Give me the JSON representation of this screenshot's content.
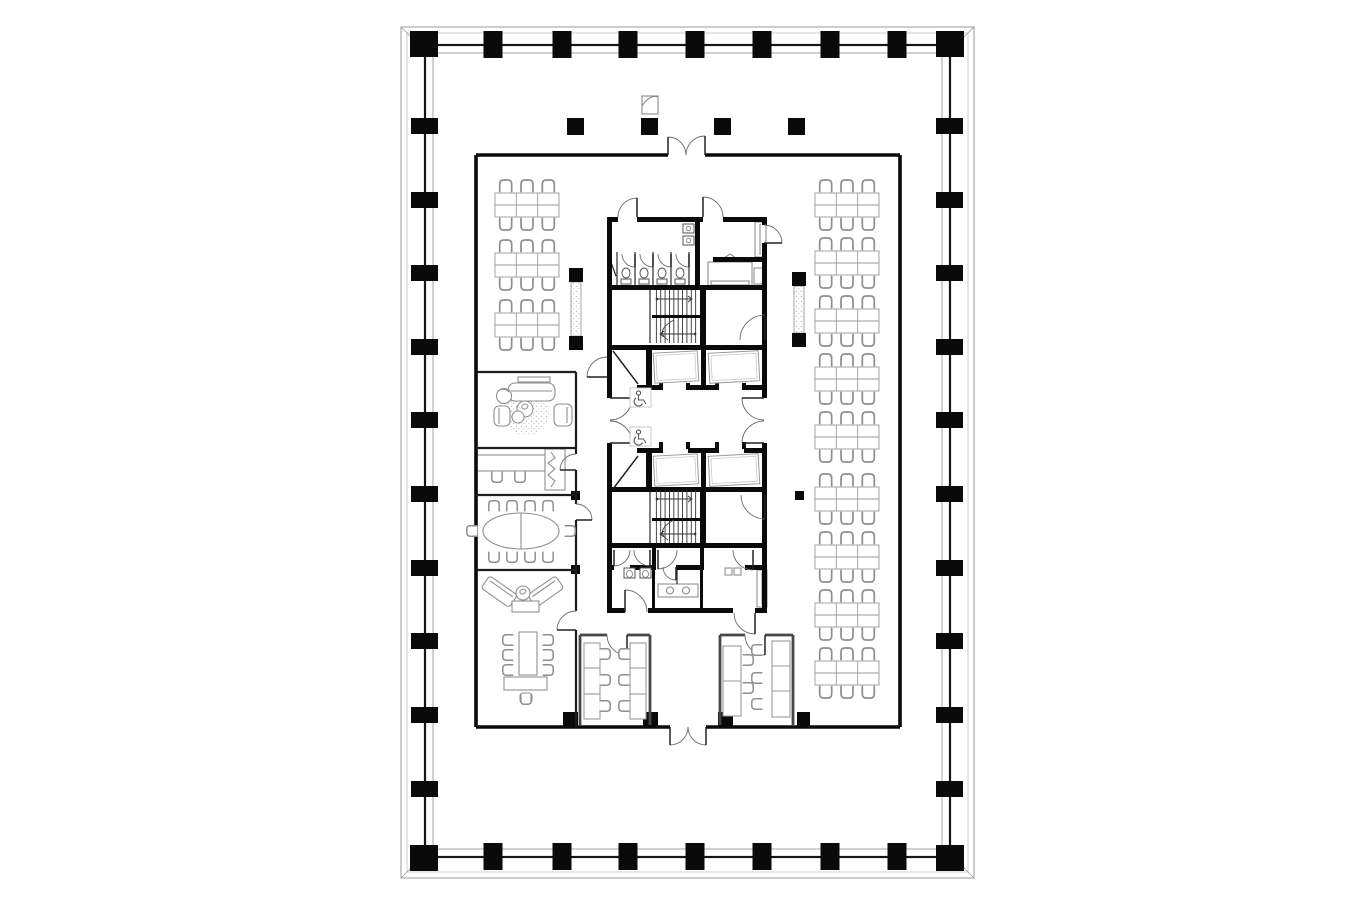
{
  "meta": {
    "document_type": "architectural-floor-plan",
    "view": "typical office tower floor plan, top view",
    "visible_text": ""
  },
  "palette": {
    "background": "#ffffff",
    "wall_black": "#0a0a0a",
    "wall_medium": "#3a3a3a",
    "shell_line": "#9a9a9a",
    "furniture": "#8f8f8f",
    "furniture_light": "#b5b5b5",
    "stipple": "#b9b9b9",
    "icon": "#5a5a5a"
  },
  "rooms": [
    {
      "name": "open-office-north",
      "desks": 0
    },
    {
      "name": "open-office-left",
      "desks": 18
    },
    {
      "name": "open-office-right",
      "desks": 54
    },
    {
      "name": "lounge",
      "seats": 4
    },
    {
      "name": "small-office",
      "seats": 2
    },
    {
      "name": "conference-room",
      "seats": 10
    },
    {
      "name": "meeting-lounge",
      "seats": 9
    },
    {
      "name": "office-cell-left",
      "workstations": 6
    },
    {
      "name": "office-cell-right",
      "workstations": 5
    },
    {
      "name": "womens-wc",
      "stalls": 4
    },
    {
      "name": "mens-wc",
      "urinals": 2
    },
    {
      "name": "pantry",
      "fixtures": 2
    },
    {
      "name": "elevator-lobby",
      "accessible_markers": 2
    },
    {
      "name": "stair-north",
      "flights": 2
    },
    {
      "name": "stair-south",
      "flights": 2
    }
  ],
  "plan": {
    "perimeter": {
      "outer": [
        401,
        27,
        974,
        878
      ],
      "outer2": [
        407,
        33,
        968,
        872
      ],
      "wall": [
        425,
        45,
        950,
        857
      ],
      "inner": [
        433,
        53,
        942,
        849
      ],
      "top_xs": [
        493,
        562,
        628,
        695,
        762,
        830,
        897
      ],
      "side_ys": [
        126,
        200,
        273,
        347,
        420,
        494,
        568,
        641,
        715,
        789
      ],
      "corners": [
        [
          410,
          31
        ],
        [
          936,
          31
        ],
        [
          410,
          845
        ],
        [
          936,
          845
        ]
      ]
    },
    "band_columns": [
      [
        567,
        118
      ],
      [
        641,
        118
      ],
      [
        714,
        118
      ],
      [
        788,
        118
      ]
    ],
    "fire_cabinet": [
      642,
      96,
      16,
      18
    ],
    "small_columns": [
      [
        571,
        491,
        9,
        9
      ],
      [
        571,
        565,
        9,
        9
      ],
      [
        795,
        491,
        9,
        9
      ]
    ],
    "wall_columns": [
      [
        563,
        712,
        15,
        14
      ],
      [
        643,
        712,
        15,
        14
      ],
      [
        718,
        712,
        15,
        14
      ],
      [
        797,
        712,
        13,
        14
      ]
    ],
    "screens": [
      {
        "x": 571,
        "y": 282,
        "w": 10,
        "h": 54,
        "caps": [
          [
            569,
            268
          ],
          [
            569,
            336
          ]
        ]
      },
      {
        "x": 794,
        "y": 286,
        "w": 10,
        "h": 47,
        "caps": [
          [
            792,
            272
          ],
          [
            792,
            333
          ]
        ]
      }
    ],
    "clusters": {
      "w": 64,
      "h": 24,
      "cols": 3,
      "left": {
        "x": 495,
        "ys": [
          193,
          253,
          313
        ]
      },
      "right": {
        "x": 815,
        "ys": [
          193,
          251,
          309,
          367,
          425,
          487,
          545,
          603,
          661
        ]
      }
    },
    "walls": {
      "inner_box": [
        [
          476,
          155,
          668,
          155
        ],
        [
          705,
          155,
          900,
          155
        ],
        [
          900,
          155,
          900,
          727
        ],
        [
          706,
          727,
          900,
          727
        ],
        [
          476,
          727,
          670,
          727
        ],
        [
          476,
          155,
          476,
          727
        ]
      ],
      "left_rooms": [
        [
          476,
          372,
          576,
          372
        ],
        [
          476,
          448,
          576,
          448
        ],
        [
          476,
          495,
          576,
          495
        ],
        [
          476,
          570,
          576,
          570
        ],
        [
          576,
          372,
          576,
          454
        ],
        [
          576,
          470,
          576,
          504
        ],
        [
          576,
          520,
          576,
          611
        ],
        [
          576,
          630,
          576,
          727
        ]
      ],
      "offices": [
        [
          580,
          635,
          607,
          635
        ],
        [
          627,
          635,
          650,
          635
        ],
        [
          580,
          635,
          580,
          725
        ],
        [
          650,
          635,
          650,
          725
        ],
        [
          720,
          635,
          745,
          635
        ],
        [
          765,
          635,
          793,
          635
        ],
        [
          720,
          635,
          720,
          725
        ],
        [
          793,
          635,
          793,
          725
        ]
      ],
      "thin": [
        [
          617,
          252,
          617,
          285
        ],
        [
          635,
          252,
          635,
          285
        ],
        [
          653,
          252,
          653,
          285
        ],
        [
          671,
          252,
          671,
          285
        ],
        [
          689,
          252,
          689,
          285
        ],
        [
          608,
          254,
          616,
          276
        ],
        [
          650,
          290,
          650,
          343
        ],
        [
          650,
          490,
          650,
          543
        ],
        [
          677,
          567,
          677,
          584
        ]
      ]
    },
    "core_wall_rects": [
      [
        607,
        217,
        11,
        5
      ],
      [
        637,
        217,
        66,
        5
      ],
      [
        723,
        217,
        44,
        5
      ],
      [
        607,
        217,
        5,
        181
      ],
      [
        607,
        443,
        5,
        170
      ],
      [
        762,
        217,
        5,
        8
      ],
      [
        762,
        243,
        5,
        155
      ],
      [
        762,
        443,
        5,
        170
      ],
      [
        607,
        608,
        18,
        5
      ],
      [
        648,
        608,
        85,
        5
      ],
      [
        755,
        608,
        12,
        5
      ],
      [
        695,
        217,
        5,
        73
      ],
      [
        607,
        285,
        160,
        5
      ],
      [
        700,
        285,
        6,
        65
      ],
      [
        607,
        345,
        160,
        5
      ],
      [
        637,
        385,
        26,
        5
      ],
      [
        688,
        385,
        31,
        5
      ],
      [
        744,
        385,
        18,
        5
      ],
      [
        646,
        345,
        6,
        45
      ],
      [
        701,
        345,
        5,
        45
      ],
      [
        637,
        448,
        26,
        5
      ],
      [
        688,
        448,
        31,
        5
      ],
      [
        744,
        448,
        18,
        5
      ],
      [
        646,
        448,
        6,
        44
      ],
      [
        701,
        448,
        5,
        44
      ],
      [
        607,
        487,
        160,
        5
      ],
      [
        700,
        487,
        6,
        61
      ],
      [
        607,
        543,
        160,
        5
      ],
      [
        652,
        548,
        4,
        22
      ],
      [
        700,
        548,
        4,
        22
      ],
      [
        607,
        565,
        7,
        5
      ],
      [
        630,
        565,
        25,
        5
      ],
      [
        676,
        565,
        27,
        5
      ],
      [
        745,
        565,
        17,
        5
      ],
      [
        652,
        565,
        3,
        43
      ],
      [
        700,
        565,
        3,
        43
      ],
      [
        713,
        257,
        49,
        5
      ]
    ],
    "jambs": [
      [
        659,
        383,
        4,
        7
      ],
      [
        686,
        383,
        4,
        7
      ],
      [
        715,
        383,
        4,
        7
      ],
      [
        742,
        383,
        4,
        7
      ],
      [
        659,
        442,
        4,
        7
      ],
      [
        686,
        442,
        4,
        7
      ],
      [
        715,
        442,
        4,
        7
      ],
      [
        742,
        442,
        4,
        7
      ]
    ],
    "stairs": [
      {
        "x": 652,
        "y": 290,
        "w": 48,
        "h": 53,
        "land": 315
      },
      {
        "x": 652,
        "y": 490,
        "w": 48,
        "h": 53,
        "land": 518
      }
    ],
    "elevator_cars": [
      [
        654,
        352,
        44,
        30
      ],
      [
        709,
        352,
        50,
        30
      ],
      [
        654,
        455,
        44,
        30
      ],
      [
        709,
        455,
        50,
        30
      ]
    ],
    "doors": [
      [
        637,
        217,
        19,
        180,
        270,
        "wc-entry"
      ],
      [
        703,
        217,
        20,
        0,
        270,
        "pantry-entry"
      ],
      [
        764,
        243,
        18,
        270,
        0,
        "pantry-east"
      ],
      [
        765,
        340,
        25,
        180,
        270,
        "stair-north-room"
      ],
      [
        610,
        398,
        22,
        90,
        0,
        "lobby-west-a"
      ],
      [
        610,
        443,
        22,
        270,
        0,
        "lobby-west-b"
      ],
      [
        764,
        398,
        22,
        90,
        180,
        "lobby-east-a"
      ],
      [
        764,
        443,
        22,
        270,
        180,
        "lobby-east-b"
      ],
      [
        765,
        495,
        24,
        180,
        90,
        "stair-south-room"
      ],
      [
        614,
        550,
        16,
        0,
        90,
        "vestibule-a1"
      ],
      [
        650,
        550,
        16,
        180,
        90,
        "vestibule-a2"
      ],
      [
        658,
        550,
        19,
        0,
        90,
        "vestibule-b"
      ],
      [
        753,
        550,
        20,
        180,
        90,
        "vestibule-c"
      ],
      [
        625,
        612,
        22,
        0,
        270,
        "wc-south-exit"
      ],
      [
        676,
        567,
        13,
        180,
        90,
        "wc-stall-mid"
      ],
      [
        755,
        613,
        21,
        180,
        90,
        "service-exit"
      ],
      [
        607,
        377,
        20,
        270,
        180,
        "corridor-north"
      ],
      [
        576,
        470,
        16,
        270,
        180,
        "small-office-door"
      ],
      [
        576,
        520,
        16,
        270,
        0,
        "conference-door"
      ],
      [
        576,
        630,
        19,
        270,
        180,
        "meeting-lounge-door"
      ],
      [
        627,
        635,
        20,
        180,
        90,
        "office-cell-left-door"
      ],
      [
        765,
        635,
        20,
        180,
        90,
        "office-cell-right-door"
      ],
      [
        668,
        155,
        18,
        0,
        270,
        "entry-north-left"
      ],
      [
        705,
        155,
        19,
        180,
        270,
        "entry-north-right"
      ],
      [
        670,
        727,
        18,
        0,
        90,
        "entry-south-left"
      ],
      [
        706,
        727,
        18,
        180,
        90,
        "entry-south-right"
      ],
      [
        635,
        254,
        13,
        180,
        90,
        "stall-1"
      ],
      [
        653,
        254,
        13,
        180,
        90,
        "stall-2"
      ],
      [
        671,
        254,
        13,
        180,
        90,
        "stall-3"
      ],
      [
        689,
        254,
        13,
        180,
        90,
        "stall-4"
      ]
    ],
    "leaf_lines": [
      [
        613,
        351,
        638,
        384
      ],
      [
        613,
        489,
        638,
        456
      ]
    ],
    "toilets": [
      [
        626,
        276
      ],
      [
        644,
        276
      ],
      [
        662,
        276
      ],
      [
        680,
        276
      ]
    ],
    "wc_sinks": [
      [
        683,
        224
      ],
      [
        683,
        236
      ]
    ],
    "urinals": [
      [
        624,
        568
      ],
      [
        640,
        568
      ]
    ],
    "wheelchair_markers": [
      [
        630,
        388
      ],
      [
        630,
        427
      ]
    ],
    "loose_chairs": [
      [
        494,
        506,
        0
      ],
      [
        512,
        506,
        0
      ],
      [
        530,
        506,
        0
      ],
      [
        548,
        506,
        0
      ],
      [
        494,
        557,
        180
      ],
      [
        512,
        557,
        180
      ],
      [
        530,
        557,
        180
      ],
      [
        548,
        557,
        180
      ],
      [
        472,
        531,
        270
      ],
      [
        570,
        531,
        90
      ],
      [
        508,
        640,
        270
      ],
      [
        508,
        655,
        270
      ],
      [
        508,
        670,
        270
      ],
      [
        548,
        640,
        90
      ],
      [
        548,
        655,
        90
      ],
      [
        548,
        670,
        90
      ],
      [
        526,
        699,
        180
      ],
      [
        497,
        477,
        180
      ],
      [
        520,
        477,
        180
      ],
      [
        605,
        654,
        90
      ],
      [
        605,
        680,
        90
      ],
      [
        605,
        706,
        90
      ],
      [
        624,
        654,
        270
      ],
      [
        624,
        680,
        270
      ],
      [
        624,
        706,
        270
      ],
      [
        748,
        660,
        90
      ],
      [
        748,
        688,
        90
      ],
      [
        757,
        650,
        270
      ],
      [
        757,
        678,
        270
      ],
      [
        757,
        704,
        270
      ]
    ]
  }
}
